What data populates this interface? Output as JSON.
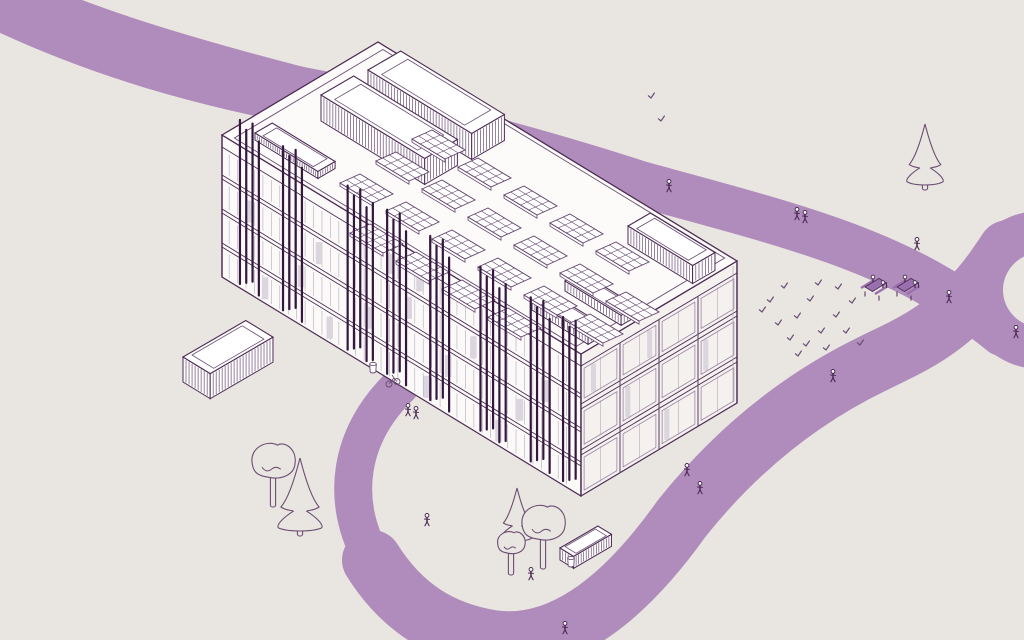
{
  "meta": {
    "description": "isometric campus site illustration: office building with rooftop solar panels, pedestrian paths, plaza, trees and people"
  },
  "colors": {
    "background": "#e9e5e0",
    "path_purple": "#b08cbc",
    "line": "#4b2b53",
    "line_soft": "#6a4e73",
    "line_faint": "#b6a8bd",
    "louver_dark": "#33173d",
    "face_sw": "#fbfaf8",
    "face_se": "#f4f1ef",
    "roof": "#fcfbf9",
    "window_gray": "#dbd5de",
    "accent_fill": "#9a6fae",
    "white": "#ffffff"
  },
  "scene": {
    "building": {
      "roof": [
        [
          222,
          135
        ],
        [
          378,
          42
        ],
        [
          737,
          261
        ],
        [
          581,
          354
        ]
      ],
      "height": 142,
      "sw_bands": [
        [
          12,
          40
        ],
        [
          44,
          74
        ],
        [
          78,
          108
        ],
        [
          112,
          142
        ]
      ],
      "se_bands": [
        [
          12,
          50
        ],
        [
          55,
          96
        ],
        [
          101,
          142
        ]
      ],
      "sw_floor_dys": [
        12,
        40,
        44,
        74,
        78,
        108,
        112
      ],
      "se_floor_dys": [
        12,
        50,
        55,
        96,
        101
      ],
      "se_mullions_major": [
        0.25,
        0.5,
        0.75
      ],
      "se_mullions_minor": [
        0.125,
        0.375,
        0.625,
        0.875
      ],
      "louver_clusters": [
        {
          "t": 0.05,
          "n": 4
        },
        {
          "t": 0.17,
          "n": 4
        },
        {
          "t": 0.35,
          "n": 5
        },
        {
          "t": 0.46,
          "n": 4
        },
        {
          "t": 0.58,
          "n": 4
        },
        {
          "t": 0.72,
          "n": 5
        },
        {
          "t": 0.86,
          "n": 4
        },
        {
          "t": 0.95,
          "n": 3
        }
      ],
      "sw_windows": [
        [
          0.08,
          1
        ],
        [
          0.12,
          3
        ],
        [
          0.22,
          2
        ],
        [
          0.27,
          1
        ],
        [
          0.3,
          3
        ],
        [
          0.41,
          2
        ],
        [
          0.47,
          0
        ],
        [
          0.52,
          1
        ],
        [
          0.57,
          3
        ],
        [
          0.63,
          2
        ],
        [
          0.7,
          1
        ],
        [
          0.77,
          3
        ],
        [
          0.83,
          2
        ],
        [
          0.9,
          1
        ],
        [
          0.55,
          0
        ]
      ],
      "se_windows": [
        [
          0.08,
          0
        ],
        [
          0.3,
          1
        ],
        [
          0.55,
          2
        ],
        [
          0.8,
          1
        ],
        [
          0.44,
          0
        ]
      ]
    },
    "roof_boxes": [
      {
        "x": 255,
        "y": 133,
        "a": 20,
        "b": 74,
        "h": 7
      },
      {
        "x": 368,
        "y": 70,
        "a": 38,
        "b": 122,
        "h": 26
      },
      {
        "x": 321,
        "y": 95,
        "a": 38,
        "b": 122,
        "h": 26
      },
      {
        "x": 628,
        "y": 226,
        "a": 26,
        "b": 76,
        "h": 18
      },
      {
        "x": 565,
        "y": 281,
        "a": 18,
        "b": 66,
        "h": 10
      },
      {
        "x": 532,
        "y": 300,
        "a": 18,
        "b": 66,
        "h": 10
      }
    ],
    "container_box": {
      "x": 183,
      "y": 357,
      "a": 73,
      "b": 32,
      "h": 25
    },
    "bus_shelter": {
      "x": 560,
      "y": 548,
      "a": 44,
      "b": 16,
      "h": 12
    },
    "solar_panels": [
      [
        432,
        130
      ],
      [
        478,
        158
      ],
      [
        524,
        186
      ],
      [
        570,
        214
      ],
      [
        616,
        242
      ],
      [
        396,
        152
      ],
      [
        442,
        180
      ],
      [
        488,
        208
      ],
      [
        534,
        236
      ],
      [
        580,
        264
      ],
      [
        626,
        292
      ],
      [
        360,
        174
      ],
      [
        406,
        202
      ],
      [
        452,
        230
      ],
      [
        498,
        258
      ],
      [
        544,
        286
      ],
      [
        590,
        314
      ],
      [
        370,
        224
      ],
      [
        416,
        252
      ],
      [
        462,
        280
      ],
      [
        508,
        308
      ]
    ],
    "walkways": {
      "band_a": {
        "d": "M -35 -30 C 110 60 400 105 640 184 C 805 229 905 253 1002 333",
        "width": 46
      },
      "band_a_wide": {
        "d": "M -60 -30 C 120 70 280 92 420 118",
        "width": 58
      },
      "band_b_main": {
        "d": "M 372 560 C 402 608 442 632 492 640 C 564 650 628 594 682 518 C 738 448 802 398 872 364 C 914 343 958 328 1008 250",
        "width": 60
      },
      "band_b_entry": {
        "d": "M 400 386 C 350 434 338 500 374 562",
        "width": 38
      },
      "ring": {
        "cx": 1040,
        "cy": 290,
        "r_outer": 79,
        "r_inner": 37
      }
    },
    "trees": [
      {
        "type": "conifer",
        "x": 925,
        "y": 182,
        "h": 58
      },
      {
        "type": "deciduous",
        "x": 273,
        "y": 466,
        "r": 22
      },
      {
        "type": "conifer",
        "x": 300,
        "y": 528,
        "h": 70
      },
      {
        "type": "conifer",
        "x": 517,
        "y": 538,
        "h": 50
      },
      {
        "type": "deciduous",
        "x": 543,
        "y": 528,
        "r": 22
      },
      {
        "type": "deciduous",
        "x": 511,
        "y": 546,
        "r": 14
      }
    ],
    "people": [
      {
        "x": 669,
        "y": 192
      },
      {
        "x": 797,
        "y": 220,
        "pair": true
      },
      {
        "x": 917,
        "y": 250
      },
      {
        "x": 949,
        "y": 303
      },
      {
        "x": 1016,
        "y": 338
      },
      {
        "x": 833,
        "y": 382
      },
      {
        "x": 687,
        "y": 476
      },
      {
        "x": 700,
        "y": 494
      },
      {
        "x": 531,
        "y": 580
      },
      {
        "x": 427,
        "y": 526
      },
      {
        "x": 408,
        "y": 416,
        "pair": true
      },
      {
        "x": 565,
        "y": 634
      }
    ],
    "picnic_tables": [
      {
        "x": 874,
        "y": 290
      },
      {
        "x": 906,
        "y": 290
      }
    ],
    "trash_bins": [
      {
        "x": 373,
        "y": 372
      },
      {
        "x": 571,
        "y": 566
      }
    ],
    "bicycle": {
      "x": 393,
      "y": 384
    },
    "grass_tufts": [
      [
        770,
        302
      ],
      [
        784,
        288
      ],
      [
        797,
        318
      ],
      [
        810,
        301
      ],
      [
        821,
        333
      ],
      [
        836,
        317
      ],
      [
        790,
        340
      ],
      [
        778,
        325
      ],
      [
        806,
        346
      ],
      [
        826,
        350
      ],
      [
        846,
        333
      ],
      [
        852,
        303
      ],
      [
        838,
        289
      ],
      [
        818,
        285
      ],
      [
        798,
        356
      ],
      [
        762,
        312
      ],
      [
        860,
        345
      ],
      [
        651,
        98
      ],
      [
        661,
        121
      ]
    ]
  }
}
